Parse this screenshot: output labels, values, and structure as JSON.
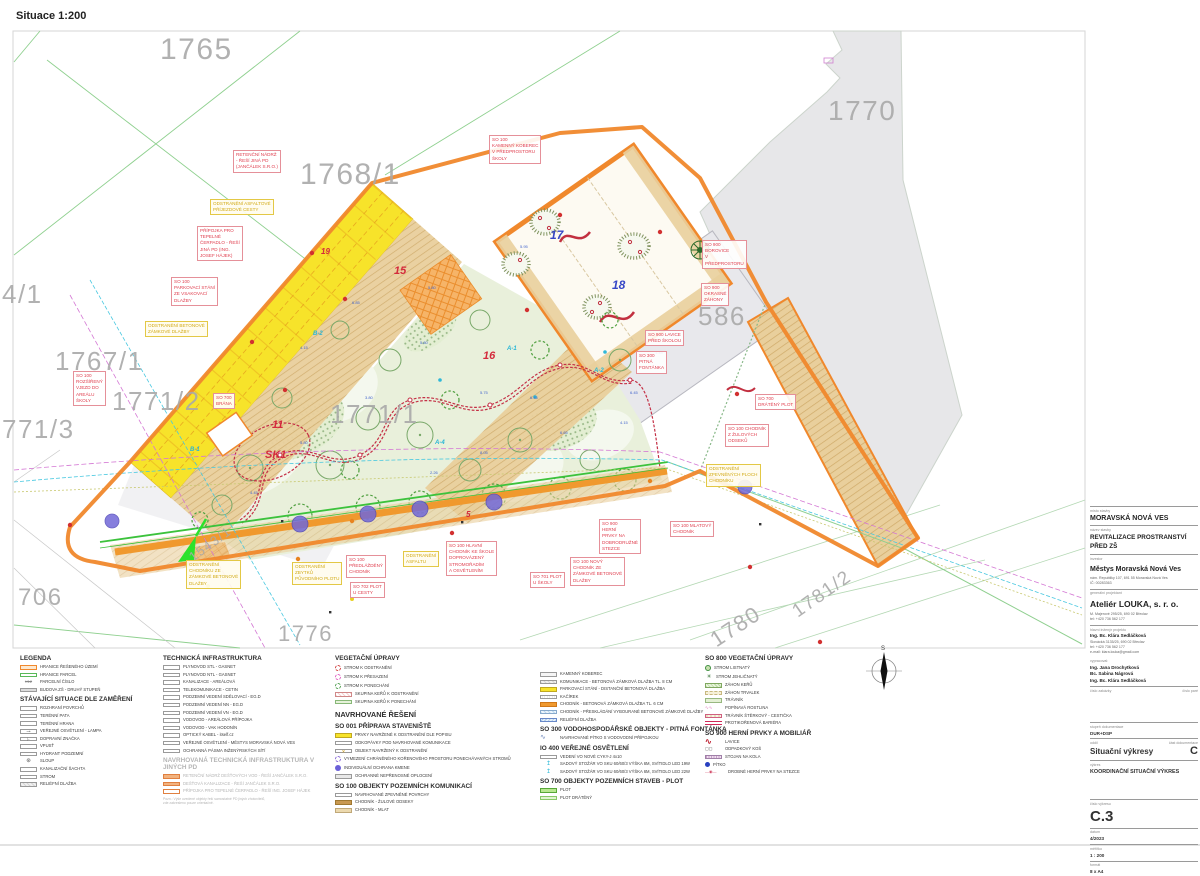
{
  "sheet": {
    "scale_label": "Situace 1:200"
  },
  "colors": {
    "boundary": "#f0882c",
    "parking": "#f7e32a",
    "walk_orange": "#f0992e",
    "mlat": "#e9cf9c",
    "garden": "#e9f0db",
    "label_red": "#e04050",
    "label_yellow": "#d2aa16",
    "parcel_gray": "#a9a9a9",
    "protect_blue": "#7268d8"
  },
  "plan": {
    "annotations": [
      {
        "k": "red",
        "x": 233,
        "y": 150,
        "t": "RETENČNÍ NÁDRŽ\n- ŘEŠÍ JINÁ PD\n(JANČÁLEK S.R.O.)"
      },
      {
        "k": "red",
        "x": 197,
        "y": 226,
        "t": "PŘÍPOJKA PRO\nTEPELNÉ\nČERPADLO - ŘEŠÍ\nJINÁ PD (ING.\nJOSEF HÁJEK)"
      },
      {
        "k": "red",
        "x": 171,
        "y": 277,
        "t": "SO 100\nPARKOVACÍ STÁNÍ\nZE VSAKOVACÍ\nDLAŽBY"
      },
      {
        "k": "red",
        "x": 73,
        "y": 371,
        "t": "SO 100\nROZŠÍŘENÝ\nVJEZD DO\nAREÁLU\nŠKOLY"
      },
      {
        "k": "red",
        "x": 213,
        "y": 393,
        "t": "SO 700\nBRÁNA"
      },
      {
        "k": "red",
        "x": 489,
        "y": 135,
        "t": "SO 100\nKAMENNÝ KOBEREC\nV PŘEDPROSTORU\nŠKOLY"
      },
      {
        "k": "red",
        "x": 702,
        "y": 240,
        "t": "SO 900\nBOROVICE\nV\nPŘEDPROSTORU"
      },
      {
        "k": "red",
        "x": 701,
        "y": 283,
        "t": "SO 900\nOKRASNÉ\nZÁHONY"
      },
      {
        "k": "red",
        "x": 645,
        "y": 330,
        "t": "SO 900 LAVICE\nPŘED ŠKOLOU"
      },
      {
        "k": "red",
        "x": 636,
        "y": 351,
        "t": "SO 300\nPITNÁ\nFONTÁNKA"
      },
      {
        "k": "red",
        "x": 755,
        "y": 394,
        "t": "SO 700\nDRÁTĚNÝ PLOT"
      },
      {
        "k": "red",
        "x": 725,
        "y": 424,
        "t": "SO 100 CHODNÍK\nZ ŽULOVÝCH\nODSEKŮ"
      },
      {
        "k": "red",
        "x": 670,
        "y": 521,
        "t": "SO 100 MLATOVÝ\nCHODNÍK"
      },
      {
        "k": "red",
        "x": 599,
        "y": 519,
        "t": "SO 900\nHERNÍ\nPRVKY NA\nDOBRODRUŽNÉ\nSTEZCE"
      },
      {
        "k": "red",
        "x": 570,
        "y": 557,
        "t": "SO 100 NOVÝ\nCHODNÍK ZE\nZÁMKOVÉ BETONOVÉ\nDLAŽBY"
      },
      {
        "k": "red",
        "x": 346,
        "y": 555,
        "t": "SO 100\nPŘEDLÁŽDĚNÝ\nCHODNÍK"
      },
      {
        "k": "red",
        "x": 446,
        "y": 541,
        "t": "SO 100 HLAVNÍ\nCHODNÍK KE ŠKOLE\nDOPROVÁZENÝ\nSTROMOŘADÍM\nA OSVĚTLENÍM"
      },
      {
        "k": "red",
        "x": 350,
        "y": 582,
        "t": "SO 702 PLOT\nU CESTY"
      },
      {
        "k": "red",
        "x": 530,
        "y": 572,
        "t": "SO 701 PLOT\nU ŠKOLY"
      },
      {
        "k": "yel",
        "x": 210,
        "y": 199,
        "t": "ODSTRANĚNÍ ASFALTOVÉ\nPŘÍJEZDOVÉ CESTY"
      },
      {
        "k": "yel",
        "x": 145,
        "y": 321,
        "t": "ODSTRANĚNÍ BETONOVÉ\nZÁMKOVÉ DLAŽBY"
      },
      {
        "k": "yel",
        "x": 706,
        "y": 464,
        "t": "ODSTRANĚNÍ\nZPEVNĚNÝCH PLOCH\nCHODNÍKU"
      },
      {
        "k": "yel",
        "x": 403,
        "y": 551,
        "t": "ODSTRANĚNÍ\nASFALTU"
      },
      {
        "k": "yel",
        "x": 186,
        "y": 560,
        "t": "ODSTRANĚNÍ\nCHODNÍKU ZE\nZÁMKOVÉ BETONOVÉ\nDLAŽBY"
      },
      {
        "k": "yel",
        "x": 292,
        "y": 562,
        "t": "ODSTRANĚNÍ\nZBYTKŮ\nPŮVODNÍHO PLOTU"
      },
      {
        "k": "parcel",
        "x": 160,
        "y": 30,
        "fs": 30,
        "t": "1765"
      },
      {
        "k": "parcel",
        "x": 300,
        "y": 155,
        "fs": 30,
        "t": "1768/1"
      },
      {
        "k": "parcel",
        "x": 828,
        "y": 93,
        "fs": 28,
        "t": "1770"
      },
      {
        "k": "parcel",
        "x": 2,
        "y": 278,
        "fs": 26,
        "t": "4/1"
      },
      {
        "k": "parcel",
        "x": 55,
        "y": 345,
        "fs": 26,
        "t": "1767/1"
      },
      {
        "k": "parcel",
        "x": 112,
        "y": 385,
        "fs": 26,
        "t": "1771/2"
      },
      {
        "k": "parcel",
        "x": 2,
        "y": 413,
        "fs": 26,
        "t": "771/3"
      },
      {
        "k": "parcel",
        "x": 330,
        "y": 398,
        "fs": 26,
        "t": "1771/1"
      },
      {
        "k": "parcel",
        "x": 698,
        "y": 300,
        "fs": 26,
        "t": "586"
      },
      {
        "k": "parcel",
        "x": 18,
        "y": 582,
        "fs": 24,
        "t": "706"
      },
      {
        "k": "parcel",
        "x": 278,
        "y": 620,
        "fs": 22,
        "t": "1776"
      },
      {
        "k": "parcel",
        "x": 705,
        "y": 630,
        "fs": 22,
        "r": -33,
        "t": "1780"
      },
      {
        "k": "parcel",
        "x": 788,
        "y": 604,
        "fs": 19,
        "r": -35,
        "t": "1781/2"
      },
      {
        "k": "parcel",
        "x": 186,
        "y": 552,
        "fs": 13,
        "r": -36,
        "t": "1543/1"
      },
      {
        "k": "nred",
        "x": 394,
        "y": 264,
        "t": "15"
      },
      {
        "k": "nred",
        "x": 483,
        "y": 349,
        "t": "16"
      },
      {
        "k": "nred",
        "x": 272,
        "y": 418,
        "t": "11"
      },
      {
        "k": "nred",
        "x": 265,
        "y": 448,
        "t": "SK1"
      },
      {
        "k": "nred",
        "x": 466,
        "y": 510,
        "fs": 8,
        "t": "5"
      },
      {
        "k": "nred",
        "x": 321,
        "y": 247,
        "fs": 8,
        "t": "19"
      },
      {
        "k": "nblue",
        "x": 550,
        "y": 228,
        "t": "17"
      },
      {
        "k": "nblue",
        "x": 612,
        "y": 278,
        "t": "18"
      },
      {
        "k": "cyan",
        "x": 313,
        "y": 331,
        "t": "B-2"
      },
      {
        "k": "cyan",
        "x": 190,
        "y": 447,
        "t": "B-1"
      },
      {
        "k": "cyan",
        "x": 507,
        "y": 346,
        "t": "A-1"
      },
      {
        "k": "cyan",
        "x": 594,
        "y": 368,
        "t": "A-2"
      },
      {
        "k": "cyan",
        "x": 435,
        "y": 440,
        "t": "A-4"
      },
      {
        "k": "dim",
        "x": 520,
        "y": 244,
        "t": "5.95"
      },
      {
        "k": "dim",
        "x": 428,
        "y": 285,
        "t": "5.80"
      },
      {
        "k": "dim",
        "x": 352,
        "y": 300,
        "t": "6.85"
      },
      {
        "k": "dim",
        "x": 300,
        "y": 345,
        "t": "4.15"
      },
      {
        "k": "dim",
        "x": 420,
        "y": 340,
        "t": "5.80"
      },
      {
        "k": "dim",
        "x": 365,
        "y": 395,
        "t": "3.80"
      },
      {
        "k": "dim",
        "x": 480,
        "y": 390,
        "t": "5.75"
      },
      {
        "k": "dim",
        "x": 530,
        "y": 395,
        "t": "6.45"
      },
      {
        "k": "dim",
        "x": 560,
        "y": 430,
        "t": "6.65"
      },
      {
        "k": "dim",
        "x": 480,
        "y": 450,
        "t": "8.05"
      },
      {
        "k": "dim",
        "x": 300,
        "y": 440,
        "t": "5.80"
      },
      {
        "k": "dim",
        "x": 430,
        "y": 470,
        "t": "2.26"
      },
      {
        "k": "dim",
        "x": 630,
        "y": 390,
        "t": "6.45"
      },
      {
        "k": "dim",
        "x": 655,
        "y": 350,
        "t": "1.45"
      },
      {
        "k": "dim",
        "x": 620,
        "y": 420,
        "t": "4.15"
      },
      {
        "k": "dim",
        "x": 250,
        "y": 490,
        "t": "4.45"
      }
    ]
  },
  "legend": {
    "col1": {
      "h1": "LEGENDA",
      "items1": [
        {
          "sw": "orange-b",
          "label": "HRANICE ŘEŠENÉHO ÚZEMÍ"
        },
        {
          "sw": "green-b",
          "label": "HRANICE PARCEL"
        },
        {
          "sw": "xnum",
          "label": "PARCELNÍ ČÍSLO"
        },
        {
          "sw": "gray",
          "label": "BUDOVA ZŠ - DRUHÝ STUPEŇ"
        }
      ],
      "h2": "STÁVAJÍCÍ SITUACE DLE ZAMĚŘENÍ",
      "items2": [
        {
          "sw": "white",
          "label": "ROZHRANÍ POVRCHŮ"
        },
        {
          "sw": "white",
          "label": "TERÉNNÍ PATA"
        },
        {
          "sw": "white",
          "label": "TERÉNNÍ HRANA"
        },
        {
          "sw": "lamp",
          "label": "VEŘEJNÉ OSVĚTLENÍ - LAMPA"
        },
        {
          "sw": "sign",
          "label": "DOPRAVNÍ ZNAČKA"
        },
        {
          "sw": "white",
          "label": "VPUSŤ"
        },
        {
          "sw": "white",
          "label": "HYDRANT PODZEMNÍ"
        },
        {
          "sw": "pole",
          "label": "SLOUP"
        },
        {
          "sw": "white",
          "label": "KANALIZAČNÍ ŠACHTA"
        },
        {
          "sw": "white",
          "label": "STROM"
        },
        {
          "sw": "gray-h",
          "label": "RELIÉFNÍ DLAŽBA"
        }
      ]
    },
    "col2": {
      "h1": "TECHNICKÁ INFRASTRUKTURA",
      "items1": [
        {
          "sw": "white",
          "label": "PLYNOVOD STL - GASNET"
        },
        {
          "sw": "white",
          "label": "PLYNOVOD NTL - GASNET"
        },
        {
          "sw": "white",
          "label": "KANALIZACE - AREÁLOVÁ"
        },
        {
          "sw": "white",
          "label": "TELEKOMUNIKACE - CETIN"
        },
        {
          "sw": "white",
          "label": "PODZEMNÍ VEDENÍ SDĚLOVACÍ - EG.D"
        },
        {
          "sw": "white",
          "label": "PODZEMNÍ VEDENÍ NN - EG.D"
        },
        {
          "sw": "white",
          "label": "PODZEMNÍ VEDENÍ VN - EG.D"
        },
        {
          "sw": "white",
          "label": "VODOVOD - AREÁLOVÁ PŘÍPOJKA"
        },
        {
          "sw": "white",
          "label": "VODOVOD - VAK HODONÍN"
        },
        {
          "sw": "white",
          "label": "OPTICKÝ KABEL - itself.cz"
        },
        {
          "sw": "white",
          "label": "VEŘEJNÉ OSVĚTLENÍ - MĚSTYS MORAVSKÁ NOVÁ VES"
        },
        {
          "sw": "white",
          "label": "OCHRANNÁ PÁSMA INŽENÝRSKÝCH SÍTÍ"
        }
      ],
      "h2": "NAVRHOVANÁ TECHNICKÁ INFRASTRUKTURA V JINÝCH PD",
      "items2": [
        {
          "sw": "or-f",
          "label": "RETENČNÍ NÁDRŽ DEŠŤOVÝCH VOD - ŘEŠÍ JANČÁLEK S.R.O."
        },
        {
          "sw": "or-f",
          "label": "DEŠŤOVÁ KANALIZACE - ŘEŠÍ JANČÁLEK S.R.O."
        },
        {
          "sw": "or-b",
          "label": "PŘÍPOJKA PRO TEPELNÉ ČERPADLO - ŘEŠÍ ING. JOSEF HÁJEK"
        }
      ],
      "note": "Pozn.: Výše uvedené objekty řeší samostatné PD jiných zhotovitelů,\nzde zakresleno pouze orientačně."
    },
    "col3": {
      "h1": "VEGETAČNÍ ÚPRAVY",
      "items1": [
        {
          "sw": "tree-red",
          "label": "STROM K ODSTRANĚNÍ"
        },
        {
          "sw": "tree-pink",
          "label": "STROM K PŘESAZENÍ"
        },
        {
          "sw": "tree-green",
          "label": "STROM K PONECHÁNÍ"
        },
        {
          "sw": "shrub-del",
          "label": "SKUPINA KEŘŮ K ODSTRANĚNÍ"
        },
        {
          "sw": "shrub-keep",
          "label": "SKUPINA KEŘŮ K PONECHÁNÍ"
        }
      ],
      "h2": "NAVRHOVANÉ ŘEŠENÍ",
      "h3": "SO 001 PŘÍPRAVA STAVENIŠTĚ",
      "items3": [
        {
          "sw": "yellow",
          "label": "PRVKY NAVRŽENÉ K ODSTRANĚNÍ DLE POPISU"
        },
        {
          "sw": "white",
          "label": "ODKOPÁVKY POD NAVRHOVANÉ KOMUNIKACE"
        },
        {
          "sw": "yellow-x",
          "label": "OBJEKT NAVRŽENÝ K ODSTRANĚNÍ"
        },
        {
          "sw": "ring",
          "label": "VYMEZENÍ CHRÁNĚNÉHO KOŘENOVÉHO PROSTORU PONECHÁVANÝCH STROMŮ"
        },
        {
          "sw": "dot-violet",
          "label": "INDIVIDUÁLNÍ OCHRANA KMENE"
        },
        {
          "sw": "gray-b",
          "label": "OCHRANNÉ NEPŘENOSNÉ OPLOCENÍ"
        }
      ],
      "h4": "SO 100 OBJEKTY POZEMNÍCH KOMUNIKACÍ",
      "items4": [
        {
          "sw": "white",
          "label": "NAVRHOVANÉ ZPEVNĚNÉ POVRCHY"
        },
        {
          "sw": "brown",
          "label": "CHODNÍK - ŽULOVÉ ODSEKY"
        },
        {
          "sw": "beige",
          "label": "CHODNÍK - MLAT"
        }
      ]
    },
    "col4": {
      "items1": [
        {
          "sw": "stone",
          "label": "KAMENNÝ KOBEREC"
        },
        {
          "sw": "gray-h",
          "label": "KOMUNIKACE - BETONOVÁ ZÁMKOVÁ DLAŽBA TL. 8 CM"
        },
        {
          "sw": "yellow",
          "label": "PARKOVACÍ STÁNÍ - DISTANČNÍ BETONOVÁ DLAŽBA"
        },
        {
          "sw": "kacirek",
          "label": "KAČÍREK"
        },
        {
          "sw": "orange",
          "label": "CHODNÍK - BETONOVÁ ZÁMKOVÁ DLAŽBA TL. 6 CM"
        },
        {
          "sw": "blue-h",
          "label": "CHODNÍK - PŘESKLÁDÁNÍ VYBOURANÉ BETONOVÉ ZÁMKOVÉ DLAŽBY"
        },
        {
          "sw": "blue-h2",
          "label": "RELIÉFNÍ DLAŽBA"
        }
      ],
      "h2": "SO 300 VODOHOSPODÁŘSKÉ OBJEKTY - PITNÁ FONTÁNKA",
      "items2": [
        {
          "sw": "squiggle",
          "label": "NAVRHOVANÉ PÍTKO S VODOVODNÍ PŘÍPOJKOU"
        }
      ],
      "h3": "IO 400 VEŘEJNÉ OSVĚTLENÍ",
      "items3": [
        {
          "sw": "white",
          "label": "VEDENÍ VO NOVÉ CYKY-J 4x10"
        },
        {
          "sw": "lampc",
          "label": "SADOVÝ STOŽÁR VO SKU 60/60/3 VÝŠKA 6M, SVÍTIDLO LED 19W"
        },
        {
          "sw": "lampc",
          "label": "SADOVÝ STOŽÁR VO SKU 60/60/3 VÝŠKA 6M, SVÍTIDLO LED 22W"
        }
      ],
      "h4": "SO 700 OBJEKTY POZEMNÍCH STAVEB - PLOT",
      "items4": [
        {
          "sw": "fence-green",
          "label": "PLOT"
        },
        {
          "sw": "fence-light",
          "label": "PLOT DRÁTĚNÝ"
        }
      ]
    },
    "col5": {
      "h1": "SO 800 VEGETAČNÍ ÚPRAVY",
      "items1": [
        {
          "sw": "tree-leaf",
          "label": "STROM LISTNATÝ"
        },
        {
          "sw": "tree-con",
          "label": "STROM JEHLIČNATÝ"
        },
        {
          "sw": "bed-shrub",
          "label": "ZÁHON KEŘŮ"
        },
        {
          "sw": "bed-per",
          "label": "ZÁHON TRVALEK"
        },
        {
          "sw": "lawn",
          "label": "TRÁVNÍK"
        },
        {
          "sw": "climber",
          "label": "POPÍNAVÁ ROSTLINA"
        },
        {
          "sw": "gravelpath",
          "label": "TRÁVNÍK ŠTĚRKOVÝ - CESTIČKA"
        },
        {
          "sw": "rootbar",
          "label": "PROTIKOŘENOVÁ BARIÉRA"
        }
      ],
      "h2": "SO 900 HERNÍ PRVKY A MOBILIÁŘ",
      "items2": [
        {
          "sw": "bench",
          "label": "LAVICE"
        },
        {
          "sw": "bin",
          "label": "ODPADKOVÝ KOŠ"
        },
        {
          "sw": "bikestand",
          "label": "STOJAN NA KOLA"
        },
        {
          "sw": "pitko",
          "label": "PÍTKO"
        },
        {
          "sw": "playel",
          "label": "DROBNÉ HERNÍ PRVKY NA STEZCE"
        }
      ]
    }
  },
  "titleblock": {
    "l_place": "místo stavby",
    "place": "MORAVSKÁ NOVÁ VES",
    "l_name": "název stavby",
    "name": "REVITALIZACE PROSTRANSTVÍ\nPŘED ZŠ",
    "l_inv": "investor",
    "inv": "Městys Moravská Nová Ves",
    "inv_addr": "nám. Republiky 107, 691 55 Moravská Nová Ves\nIČ: 00283363",
    "l_gp": "generální projektant",
    "gp": "Ateliér LOUKA, s. r. o.",
    "gp_addr": "M. Majerové 295/25, 690 02 Břeclav\ntel: +420 736 562 177",
    "l_hip": "hlavní inženýr projektu",
    "hip": "Ing. Bc. Klára Sedláčková",
    "hip_addr": "Slovácká 3135/25, 690 02 Břeclav\ntel: +420 736 562 177\ne-mail: klara.louka@gmail.com",
    "l_vyp": "vypracoval:",
    "vyp": [
      {
        "name": "Ing. Jana Drochytková"
      },
      {
        "name": "Bc. Sabina Nágrová"
      },
      {
        "name": "Ing. Bc. Klára Sedláčková"
      }
    ],
    "l_zakazka": "číslo zakázky",
    "l_pare": "číslo paré",
    "l_stup": "stupeň dokumentace",
    "stup": "DUR+DSP",
    "l_oddil": "oddíl",
    "oddil": "Situační výkresy",
    "l_cast": "část dokumentace",
    "cast": "C",
    "l_vykres": "výkres",
    "vykres": "KOORDINAČNÍ SITUAČNÍ VÝKRES",
    "l_cislo": "číslo výkresu",
    "cislo": "C.3",
    "l_datum": "datum",
    "datum": "4/2023",
    "l_mer": "měřítko",
    "mer": "1 : 200",
    "l_fmt": "formát",
    "fmt": "8 x A4",
    "compass_n": "S"
  }
}
